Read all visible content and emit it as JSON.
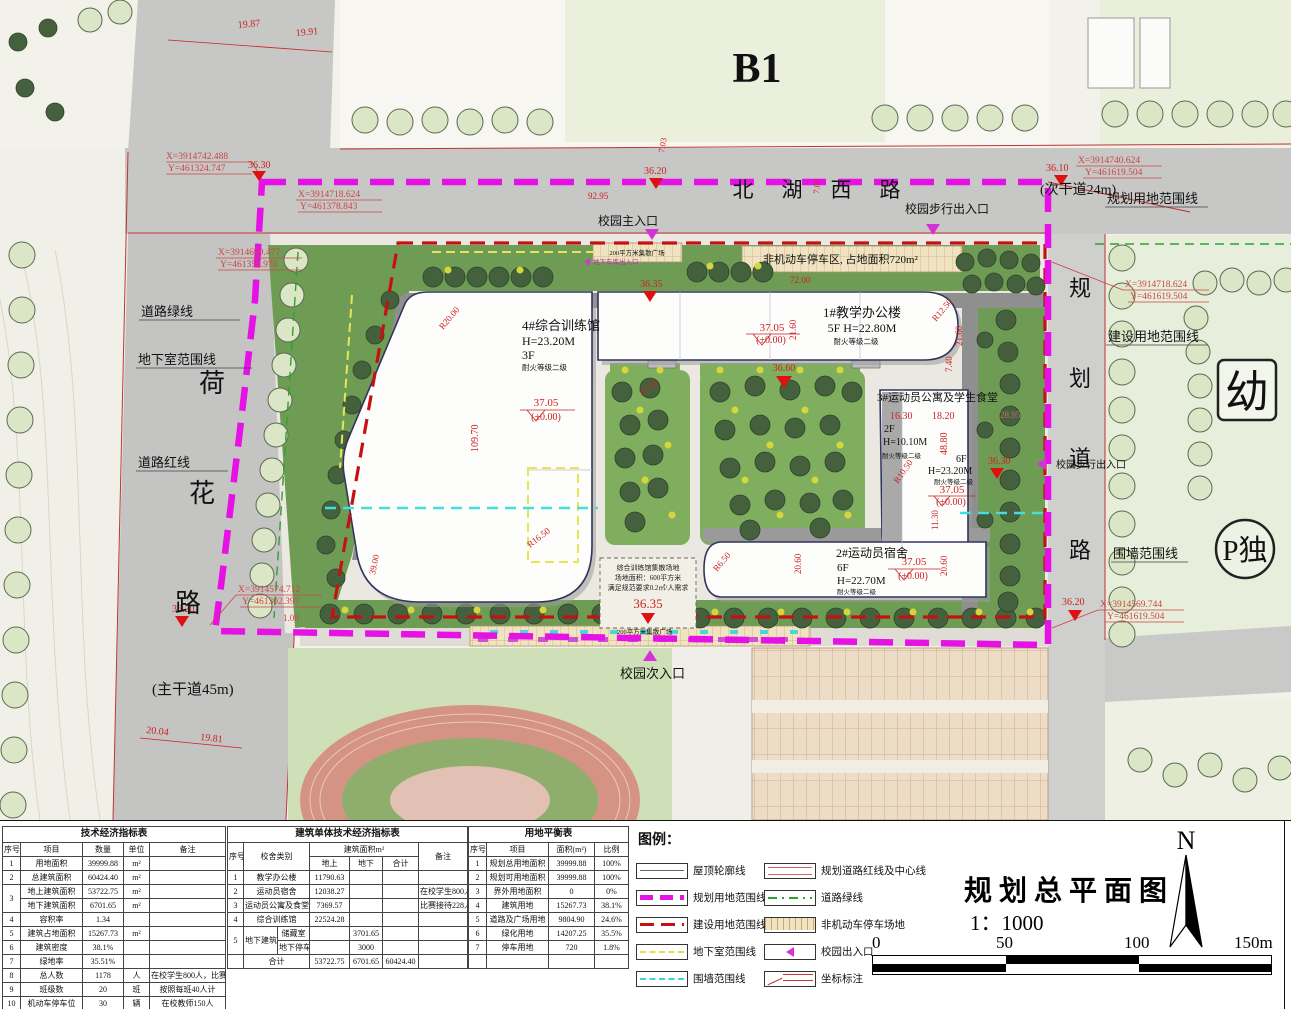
{
  "plan": {
    "b1_label": "B1",
    "road_north": [
      "北",
      "湖",
      "西",
      "路"
    ],
    "road_north_note": "(次干道24m)",
    "road_west": [
      "荷",
      "花",
      "路"
    ],
    "road_west_note": "(主干道45m)",
    "road_east": [
      "规",
      "划",
      "道",
      "路"
    ],
    "kindergarten": "幼",
    "parking_badge": "P独",
    "labels": {
      "plan_boundary": "规划用地范围线",
      "build_boundary": "建设用地范围线",
      "wall_boundary": "围墙范围线",
      "basement_boundary": "地下室范围线",
      "road_green": "道路绿线",
      "road_red": "道路红线",
      "ped_exit": "校园步行出入口",
      "main_entrance": "校园主入口",
      "secondary_entrance": "校园次入口",
      "bike_parking": "非机动车停车区, 占地面积720m²",
      "plaza200": "200平方米集散广场",
      "garage_entrance": "地下车库出入口"
    },
    "note": {
      "l1": "综合训练馆集散场地",
      "l2": "场地面积：600平方米",
      "l3": "满足规范要求0.2㎡/人需求"
    },
    "buildings": {
      "b4": {
        "name": "4#综合训练馆",
        "h": "H=23.20M",
        "f": "3F",
        "fire": "耐火等级二级"
      },
      "b1": {
        "name": "1#教学办公楼",
        "fh": "5F  H=22.80M",
        "fire": "耐火等级二级"
      },
      "b3": {
        "name": "3#运动员公寓及学生食堂",
        "f1": "2F",
        "h1": "H=10.10M",
        "fire1": "耐火等级二级",
        "f2": "6F",
        "h2": "H=23.20M",
        "fire2": "耐火等级二级"
      },
      "b2": {
        "name": "2#运动员宿舍",
        "f": "6F",
        "h": "H=22.70M",
        "fire": "耐火等级二级"
      }
    },
    "elev": {
      "e3705": "37.05",
      "pm": "(±0.00)",
      "e3635": "36.35",
      "e3660": "36.60",
      "e3650": "36.50",
      "e3630": "36.30",
      "e3620": "36.20",
      "e3610": "36.10"
    },
    "coords": [
      {
        "x": "X=3914742.488",
        "y": "Y=461324.747"
      },
      {
        "x": "X=3914718.624",
        "y": "Y=461378.843"
      },
      {
        "x": "X=3914699.477",
        "y": "Y=461356.970"
      },
      {
        "x": "X=3914574.712",
        "y": "Y=461302.397"
      },
      {
        "x": "X=3914740.624",
        "y": "Y=461619.504"
      },
      {
        "x": "X=3914718.624",
        "y": "Y=461619.504"
      },
      {
        "x": "X=3914569.744",
        "y": "Y=461619.504"
      }
    ],
    "dims": {
      "d1987": "19.87",
      "d1991": "19.91",
      "d9295": "92.95",
      "d703": "7.03",
      "d705": "7.05",
      "d7200": "72.00",
      "d10970": "109.70",
      "r20": "R20.00",
      "r165": "R16.50",
      "r125": "R12.50",
      "r105": "R10.50",
      "r65": "R6.50",
      "d1630": "16.30",
      "d1820": "18.20",
      "d4880": "48.80",
      "d2160": "21.60",
      "d740": "7.40",
      "d2060": "20.60",
      "d1130": "11.30",
      "d3900": "39.00",
      "d2004": "20.04",
      "d1981": "19.81",
      "d2895": "28.95",
      "d100": "1.00"
    }
  },
  "tables": {
    "t1": {
      "rows": [
        [
          {
            "t": "技术经济指标表",
            "cs": 5,
            "cls": "tt"
          }
        ],
        [
          "序号",
          "项目",
          "数量",
          "单位",
          "备注"
        ],
        [
          "1",
          "用地面积",
          "39999.88",
          "m²",
          ""
        ],
        [
          "2",
          "总建筑面积",
          "60424.40",
          "m²",
          ""
        ],
        [
          {
            "t": "3",
            "rs": 2
          },
          "地上建筑面积",
          "53722.75",
          "m²",
          ""
        ],
        [
          "地下建筑面积",
          "6701.65",
          "m²",
          ""
        ],
        [
          "4",
          "容积率",
          "1.34",
          "",
          ""
        ],
        [
          "5",
          "建筑占地面积",
          "15267.73",
          "m²",
          ""
        ],
        [
          "6",
          "建筑密度",
          "38.1%",
          "",
          ""
        ],
        [
          "7",
          "绿地率",
          "35.51%",
          "",
          ""
        ],
        [
          "8",
          "总人数",
          "1178",
          "人",
          "在校学生800人，比赛228人"
        ],
        [
          "9",
          "班级数",
          "20",
          "班",
          "按照每班40人计"
        ],
        [
          "10",
          "机动车停车位",
          "30",
          "辆",
          "在校教师150人"
        ],
        [
          "11",
          "非机动车停车位",
          "412",
          "辆",
          ""
        ]
      ]
    },
    "t2": {
      "rows": [
        [
          {
            "t": "建筑单体技术经济指标表",
            "cs": 7,
            "cls": "tt"
          }
        ],
        [
          {
            "t": "序号",
            "rs": 2
          },
          {
            "t": "校舍类别",
            "rs": 2,
            "cs": 2
          },
          {
            "t": "建筑面积m²",
            "cs": 3
          },
          {
            "t": "备注",
            "rs": 2
          }
        ],
        [
          "地上",
          "地下",
          "合计"
        ],
        [
          "1",
          {
            "t": "教学办公楼",
            "cs": 2
          },
          "11790.63",
          "",
          "",
          ""
        ],
        [
          "2",
          {
            "t": "运动员宿舍",
            "cs": 2
          },
          "12038.27",
          "",
          "",
          "在校学生800人"
        ],
        [
          "3",
          {
            "t": "运动员公寓及食堂",
            "cs": 2
          },
          "7369.57",
          "",
          "",
          "比赛接待228人"
        ],
        [
          "4",
          {
            "t": "综合训练馆",
            "cs": 2
          },
          "22524.28",
          "",
          "",
          ""
        ],
        [
          {
            "t": "5",
            "rs": 2
          },
          {
            "t": "地下建筑",
            "rs": 2
          },
          "储藏室",
          "",
          "3701.65",
          "",
          ""
        ],
        [
          "地下停车",
          "",
          "3000",
          "",
          ""
        ],
        [
          "",
          {
            "t": "合计",
            "cs": 2
          },
          "53722.75",
          "6701.65",
          "60424.40",
          ""
        ]
      ]
    },
    "t3": {
      "rows": [
        [
          {
            "t": "用地平衡表",
            "cs": 4,
            "cls": "tt"
          }
        ],
        [
          "序号",
          "项目",
          "面积(m²)",
          "比例"
        ],
        [
          "1",
          "规划总用地面积",
          "39999.88",
          "100%"
        ],
        [
          "2",
          "规划可用地面积",
          "39999.88",
          "100%"
        ],
        [
          "3",
          "界外用地面积",
          "0",
          "0%"
        ],
        [
          "4",
          "建筑用地",
          "15267.73",
          "38.1%"
        ],
        [
          "5",
          "道路及广场用地",
          "9804.90",
          "24.6%"
        ],
        [
          "6",
          "绿化用地",
          "14207.25",
          "35.5%"
        ],
        [
          "7",
          "停车用地",
          "720",
          "1.8%"
        ],
        [
          "",
          "",
          "",
          ""
        ]
      ]
    }
  },
  "panel": {
    "legend_title": "图例：",
    "legend_items": [
      {
        "label": "屋顶轮廓线"
      },
      {
        "label": "规划用地范围线"
      },
      {
        "label": "建设用地范围线"
      },
      {
        "label": "地下室范围线"
      },
      {
        "label": "围墙范围线"
      },
      {
        "label": "规划道路红线及中心线"
      },
      {
        "label": "道路绿线"
      },
      {
        "label": "非机动车停车场地"
      },
      {
        "label": "校园出入口"
      },
      {
        "label": "坐标标注"
      }
    ],
    "title": "规划总平面图",
    "scale": "1：1000",
    "north": "N",
    "scalebar": [
      "0",
      "50",
      "100",
      "150m"
    ]
  },
  "colors": {
    "plan_boundary": "#e511e5",
    "build_boundary": "#c51111",
    "basement": "#dede55",
    "wall": "#3cd5d5",
    "road_green": "#2da32d",
    "annotation_red": "#cc2222"
  }
}
